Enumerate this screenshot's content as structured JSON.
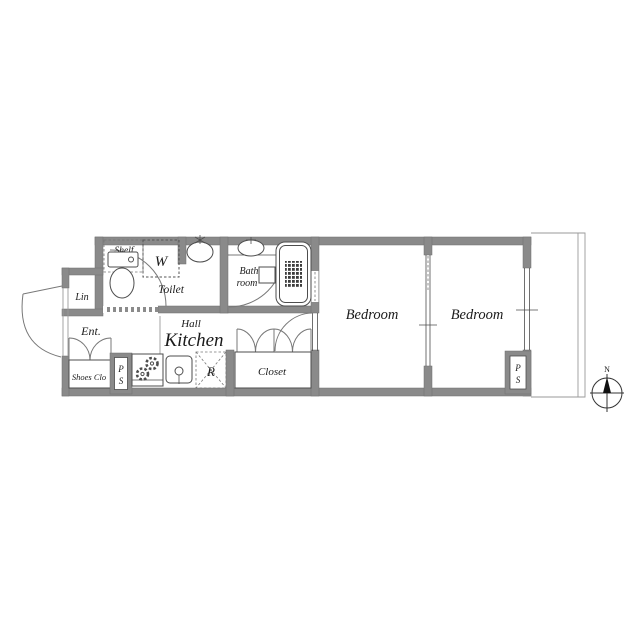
{
  "colors": {
    "wall": "#8a8a8a",
    "line": "#4d4d4d",
    "background": "#ffffff"
  },
  "labels": {
    "shelf": "Shelf",
    "washer": "W",
    "toilet": "Toilet",
    "bath1": "Bath",
    "bath2": "room",
    "linen": "Lin",
    "entrance": "Ent.",
    "shoes_closet": "Shoes Clo",
    "ps_p": "P",
    "ps_s": "S",
    "hall": "Hall",
    "kitchen": "Kitchen",
    "fridge": "R",
    "closet": "Closet",
    "bedroom1": "Bedroom",
    "bedroom2": "Bedroom",
    "compass_north": "N"
  }
}
